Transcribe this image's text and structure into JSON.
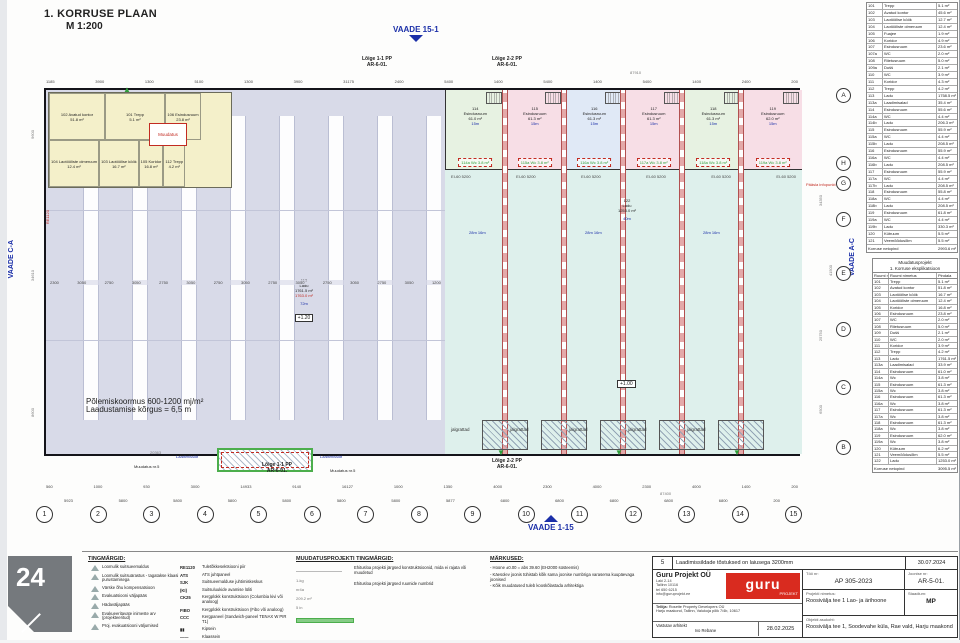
{
  "page": {
    "title": "1. KORRUSE PLAAN",
    "scale": "M 1:200",
    "watermark": "24"
  },
  "views": {
    "top": "VAADE 15-1",
    "bottom": "VAADE 1-15",
    "left": "VAADE C-A",
    "right": "VAADE A-C"
  },
  "sections": {
    "s1": "Lõige 1-1 PP",
    "s2": "Lõige 2-2 PP",
    "ref": "AR-6-01.",
    "muudatus5_left": "Muudatus nr.5",
    "muudatus5_right": "Muudatus nr.5",
    "muudatus_office": "Muudatus",
    "laadimissild_left": "Laadimissild",
    "laadimissild_right": "Laadimissild",
    "paasla": "Pääsla infopunkt",
    "wall_code": "RE1120"
  },
  "plan": {
    "warehouse_left": {
      "number": "113",
      "name": "Ladu",
      "area": "1761.5 m²",
      "area_red": "1763.0 m²",
      "rack_note": "72m",
      "level": "+1.20"
    },
    "warehouse_right": {
      "number": "122",
      "name": "Ladu",
      "area": "1253.0 m²",
      "rack_note": "40m",
      "level": "+1.00"
    },
    "fire_note1": "Põlemiskoormus 600-1200 mj/m²",
    "fire_note2": "Laadustamise kõrgus = 6,5 m",
    "rack_note_a": "28m",
    "rack_note_b": "16m",
    "office_rooms": [
      {
        "num": "102",
        "name": "Avatud kontor",
        "area": "51.8 m²"
      },
      {
        "num": "101",
        "name": "Trepp",
        "area": "5.1 m²"
      },
      {
        "num": "106",
        "name": "Esindusruum",
        "area": "23.8 m²"
      },
      {
        "num": "104",
        "name": "Laotööliste olmeruum",
        "area": "12.4 m²"
      },
      {
        "num": "103",
        "name": "Laotöölise köök",
        "area": "16.7 m²"
      },
      {
        "num": "105",
        "name": "Koridor",
        "area": "16.8 m²"
      },
      {
        "num": "112",
        "name": "Trepp",
        "area": "4.2 m²"
      }
    ],
    "units": [
      {
        "number": "114",
        "name": "Esindusruum",
        "area": "61.0 m²",
        "sub": "15m",
        "wc": "114a Wc 3.8 m²",
        "fire": "EI-60  5200",
        "tint": "#e7f2e2"
      },
      {
        "number": "115",
        "name": "Esindusruum",
        "area": "61.3 m²",
        "sub": "15m",
        "wc": "115a Wc 3.8 m²",
        "fire": "EI-60  5200",
        "tint": "#f7dee6"
      },
      {
        "number": "116",
        "name": "Esindusruum",
        "area": "61.3 m²",
        "sub": "15m",
        "wc": "116a Wc 3.8 m²",
        "fire": "EI-60  5200",
        "tint": "#e0e9f6"
      },
      {
        "number": "117",
        "name": "Esindusruum",
        "area": "61.3 m²",
        "sub": "15m",
        "wc": "117a Wc 3.8 m²",
        "fire": "EI-60  5200",
        "tint": "#f7dee6"
      },
      {
        "number": "118",
        "name": "Esindusruum",
        "area": "61.3 m²",
        "sub": "15m",
        "wc": "118a Wc 3.8 m²",
        "fire": "EI-60  5200",
        "tint": "#e7f2e2"
      },
      {
        "number": "119",
        "name": "Esindusruum",
        "area": "62.0 m²",
        "sub": "15m",
        "wc": "119a Wc 3.8 m²",
        "fire": "EI-60  5200",
        "tint": "#f7dee6"
      }
    ],
    "bike_labels": [
      "jalgrattad",
      "jalgrattad",
      "jalgrattad",
      "jalgrattad",
      "jalgrattad"
    ],
    "grid_cols": [
      "1",
      "2",
      "3",
      "4",
      "5",
      "6",
      "7",
      "8",
      "9",
      "10",
      "11",
      "12",
      "13",
      "14",
      "15"
    ],
    "grid_rows": [
      "H",
      "G",
      "F",
      "E",
      "D",
      "C",
      "B",
      "A"
    ],
    "dims_overall_top": "87910",
    "dims_top": [
      "1185",
      "3900",
      "1300",
      "5100",
      "1300",
      "3900",
      "31175",
      "2400",
      "5400",
      "1400",
      "5400",
      "1400",
      "5400",
      "1400",
      "2400",
      "200"
    ],
    "dims_mid": [
      "2300",
      "3050",
      "2750",
      "3050",
      "2750",
      "3050",
      "2750",
      "3050",
      "2750",
      "3050",
      "2750",
      "3050",
      "2750",
      "3050",
      "1200"
    ],
    "dims_bottom1": [
      "560",
      "1000",
      "930",
      "3000",
      "14933",
      "9140",
      "16127",
      "1000",
      "1350",
      "4000",
      "2300",
      "4000",
      "2300",
      "4000",
      "1400",
      "200"
    ],
    "dims_overall_bottom": "87400",
    "dims_bottom2": [
      "5923",
      "5800",
      "5800",
      "5800",
      "5800",
      "5800",
      "5800",
      "5877",
      "6800",
      "6800",
      "6800",
      "6800",
      "6800",
      "200"
    ],
    "dims_left": [
      "200",
      "9600",
      "34610",
      "8600",
      "200"
    ],
    "dims_right": [
      "2400",
      "2500",
      "1000",
      "2300",
      "34350",
      "41500",
      "25750",
      "6500"
    ],
    "dim_misc": "20363"
  },
  "table_top": {
    "rows": [
      [
        "101",
        "Trepp",
        "5.1 m²"
      ],
      [
        "102",
        "Avatud kontor",
        "45.6 m²"
      ],
      [
        "103",
        "Laotöölise köök",
        "12.7 m²"
      ],
      [
        "104",
        "Laotööliste olmeruum",
        "12.4 m²"
      ],
      [
        "105",
        "Fuajee",
        "1.9 m²"
      ],
      [
        "106",
        "Koridor",
        "4.9 m²"
      ],
      [
        "107",
        "Esindusruum",
        "23.6 m²"
      ],
      [
        "107a",
        "WC",
        "2.0 m²"
      ],
      [
        "108",
        "Riietusruum",
        "5.0 m²"
      ],
      [
        "109a",
        "Dušš",
        "2.1 m²"
      ],
      [
        "110",
        "WC",
        "3.9 m²"
      ],
      [
        "111",
        "Koridor",
        "4.3 m²"
      ],
      [
        "112",
        "Trepp",
        "4.2 m²"
      ],
      [
        "113",
        "Ladu",
        "1758.5 m²"
      ],
      [
        "113a",
        "Laadimisalad",
        "35.4 m²"
      ],
      [
        "114",
        "Esindusruum",
        "55.6 m²"
      ],
      [
        "114a",
        "WC",
        "4.4 m²"
      ],
      [
        "114b",
        "Ladu",
        "206.3 m²"
      ],
      [
        "115",
        "Esindusruum",
        "55.9 m²"
      ],
      [
        "115a",
        "WC",
        "4.4 m²"
      ],
      [
        "115b",
        "Ladu",
        "208.5 m²"
      ],
      [
        "116",
        "Esindusruum",
        "55.9 m²"
      ],
      [
        "116a",
        "WC",
        "4.4 m²"
      ],
      [
        "116b",
        "Ladu",
        "208.5 m²"
      ],
      [
        "117",
        "Esindusruum",
        "55.9 m²"
      ],
      [
        "117a",
        "WC",
        "4.4 m²"
      ],
      [
        "117b",
        "Ladu",
        "208.5 m²"
      ],
      [
        "118",
        "Esindusruum",
        "55.8 m²"
      ],
      [
        "118a",
        "WC",
        "4.4 m²"
      ],
      [
        "118b",
        "Ladu",
        "208.5 m²"
      ],
      [
        "119",
        "Esindusruum",
        "61.8 m²"
      ],
      [
        "119a",
        "WC",
        "4.4 m²"
      ],
      [
        "119b",
        "Ladu",
        "330.3 m²"
      ],
      [
        "120",
        "Kütruum",
        "5.5 m²"
      ],
      [
        "121",
        "Veemõõdusõlm",
        "5.5 m²"
      ]
    ],
    "footer_label": "Korruse netopind",
    "footer_value": "2993.6 m²"
  },
  "table_main": {
    "title1": "Muudatusprojekt",
    "title2": "1. Korruse eksplikatsioon",
    "col1": "Ruumi nr",
    "col2": "Ruumi nimetus",
    "col3": "Pindala",
    "rows": [
      [
        "101",
        "Trepp",
        "5.1 m²"
      ],
      [
        "102",
        "Avatud kontor",
        "51.8 m²"
      ],
      [
        "103",
        "Laotöölise köök",
        "16.7 m²"
      ],
      [
        "104",
        "Laotööliste olmeruum",
        "12.4 m²"
      ],
      [
        "105",
        "Koridor",
        "16.8 m²"
      ],
      [
        "106",
        "Esindusruum",
        "23.8 m²"
      ],
      [
        "107",
        "WC",
        "2.0 m²"
      ],
      [
        "108",
        "Riietusruum",
        "5.0 m²"
      ],
      [
        "109",
        "Dušš",
        "2.1 m²"
      ],
      [
        "110",
        "WC",
        "2.0 m²"
      ],
      [
        "111",
        "Koridor",
        "3.9 m²"
      ],
      [
        "112",
        "Trepp",
        "4.2 m²"
      ],
      [
        "113",
        "Ladu",
        "1761.5 m²"
      ],
      [
        "113a",
        "Laadimisalad",
        "33.9 m²"
      ],
      [
        "114",
        "Esindusruum",
        "61.0 m²"
      ],
      [
        "114a",
        "Wc",
        "3.8 m²"
      ],
      [
        "115",
        "Esindusruum",
        "61.3 m²"
      ],
      [
        "115a",
        "Wc",
        "3.8 m²"
      ],
      [
        "116",
        "Esindusruum",
        "61.3 m²"
      ],
      [
        "116a",
        "Wc",
        "3.8 m²"
      ],
      [
        "117",
        "Esindusruum",
        "61.3 m²"
      ],
      [
        "117a",
        "Wc",
        "3.8 m²"
      ],
      [
        "118",
        "Esindusruum",
        "61.3 m²"
      ],
      [
        "118a",
        "Wc",
        "3.8 m²"
      ],
      [
        "119",
        "Esindusruum",
        "62.0 m²"
      ],
      [
        "119a",
        "Wc",
        "3.8 m²"
      ],
      [
        "120",
        "Kütruum",
        "6.2 m²"
      ],
      [
        "121",
        "Veemõõdusõlm",
        "5.5 m²"
      ],
      [
        "122",
        "Ladu",
        "1253.0 m²"
      ]
    ],
    "footer_label": "Korruse netopind",
    "footer_value": "3095.5 m²"
  },
  "legend": {
    "heading": "TINGMÄRGID:",
    "items": [
      {
        "icon": "triangle",
        "label": "Loomulik suitsueemaldus"
      },
      {
        "icon": "triangle-dashed",
        "label": "Loomulik suitsuärastus - tagatakse klaasi purustamisega"
      },
      {
        "icon": "triangle-small",
        "label": "Värske õhu kompensatsioon"
      },
      {
        "icon": "circle",
        "label": "Evakuatsiooni väljapääs"
      },
      {
        "icon": "red-dot",
        "label": "Hädaväljapääs"
      },
      {
        "icon": "green-arrow",
        "label": "Evakueeritavate inimeste arv (projekteeritud)"
      },
      {
        "icon": "green-arrow",
        "label": "Proj. evakuatsiooni väljumised"
      }
    ],
    "codes": [
      {
        "code": "RE1120",
        "red": true,
        "label": "Tuletõkkesektsiooni piir"
      },
      {
        "code": "ATS",
        "red": false,
        "label": "ATS juhtpaneel"
      },
      {
        "code": "SJK",
        "red": false,
        "label": "Suitsueemalduse juhtimiskeskus"
      },
      {
        "code": "(KI)",
        "red": false,
        "label": "Suitsuluukide avamise lüliti"
      },
      {
        "code": "CK25",
        "red": false,
        "label": "Kergplokk konstruktsioon (Columbia kivi või analoog)"
      },
      {
        "code": "FIBO",
        "red": false,
        "label": "Kergplokk konstruktsioon (Fibo või analoog)"
      },
      {
        "code": "CCC",
        "red": false,
        "label": "Kergpaneel (Sandwich-paneel TENAX W PIR T1)"
      },
      {
        "code": "▮▮",
        "red": false,
        "label": "Kipsein"
      },
      {
        "code": "——",
        "red": false,
        "label": "Klaassein"
      }
    ]
  },
  "muudatus_legend": {
    "heading": "MUUDATUSPROJEKTI TINGMÄRGID:",
    "items": [
      "Ehitusloa projekti järgsed konstruktsioonid, mida ei rajata või muudetud",
      "Ehitusloa projekti järgsed ruumide numbrid"
    ]
  },
  "markused": {
    "heading": "MÄRKUSED:",
    "items": [
      "- Hoone ±0.00 = abs 39.60 (EH2000 süsteemis)",
      "- Käesolev joonis tühistab kõik sama joonise numbriga varasema kuupäevaga joonised",
      "- Kõik muudatused tuleb kooskõlastada arhitektiga"
    ]
  },
  "titleblock": {
    "rev_nr": "5",
    "rev_text": "Laadimissildade tõstuksed on laiusega 3200mm",
    "rev_date": "30.07.2024",
    "company": "Guru Projekt OÜ",
    "addr1": "Laki 2-14",
    "addr2": "Tallinn 10116",
    "addr3": "tel 650 6215",
    "addr4": "info@guruprojekt.ee",
    "logo_text": "guru",
    "logo_sub": "PROJEKT",
    "client_label": "Tellija:",
    "client_name": "Rosette Property Developers OÜ",
    "client_addr": "Harju maakond, Tallinn, Valukoja põik 7/4b, 10617",
    "architect_label": "Vastutav arhitekt",
    "architect": "Ivo Rebane",
    "date": "28.02.2025",
    "work_label": "Töö nr:",
    "work_nr": "AP 305-2023",
    "drawing_label": "Joonise nr:",
    "drawing_nr": "AR-5-01.",
    "project_label": "Projekti nimetus:",
    "project": "Roosivälja tee 1 Lao- ja ärihoone",
    "stage_label": "Staadium:",
    "stage": "MP",
    "location_label": "Objekti asukoht:",
    "location": "Roosivälja tee 1, Soodevahe küla, Rae vald, Harju maakond"
  }
}
